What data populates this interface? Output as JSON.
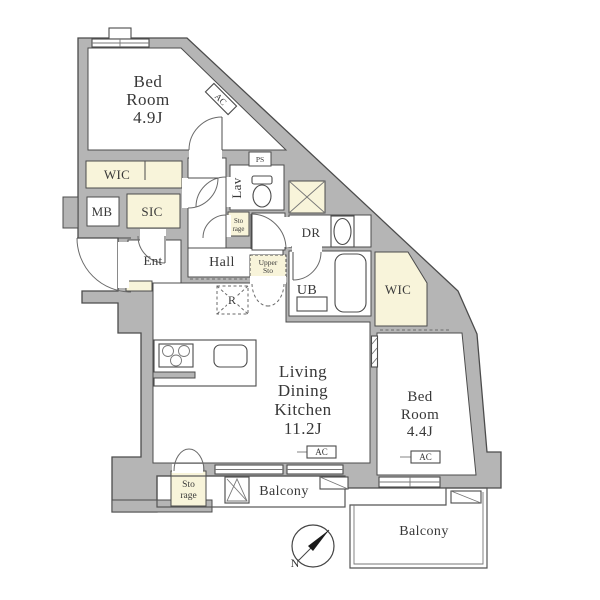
{
  "plan": {
    "colors": {
      "wall": "#b5b5b5",
      "outline": "#4c4c4c",
      "closet": "#f8f4da",
      "text": "#383838"
    },
    "rooms": {
      "bedroom_top": {
        "l1": "Bed",
        "l2": "Room",
        "size": "4.9J"
      },
      "ldk": {
        "l1": "Living",
        "l2": "Dining",
        "l3": "Kitchen",
        "size": "11.2J"
      },
      "bedroom_right": {
        "l1": "Bed",
        "l2": "Room",
        "size": "4.4J"
      },
      "wic_left": "WIC",
      "wic_right": "WIC",
      "sic": "SIC",
      "mb": "MB",
      "ent": "Ent",
      "lav": "Lav",
      "ps": "PS",
      "dr": "DR",
      "ub": "UB",
      "hall": "Hall",
      "storage_hall": {
        "l1": "Sto",
        "l2": "rage"
      },
      "upper_storage": {
        "l1": "Upper",
        "l2": "Sto"
      },
      "storage_ldk": {
        "l1": "Sto",
        "l2": "rage"
      },
      "balcony_left": "Balcony",
      "balcony_right": "Balcony"
    },
    "fixtures": {
      "ac": "AC",
      "fridge": "R",
      "north": "N"
    }
  }
}
